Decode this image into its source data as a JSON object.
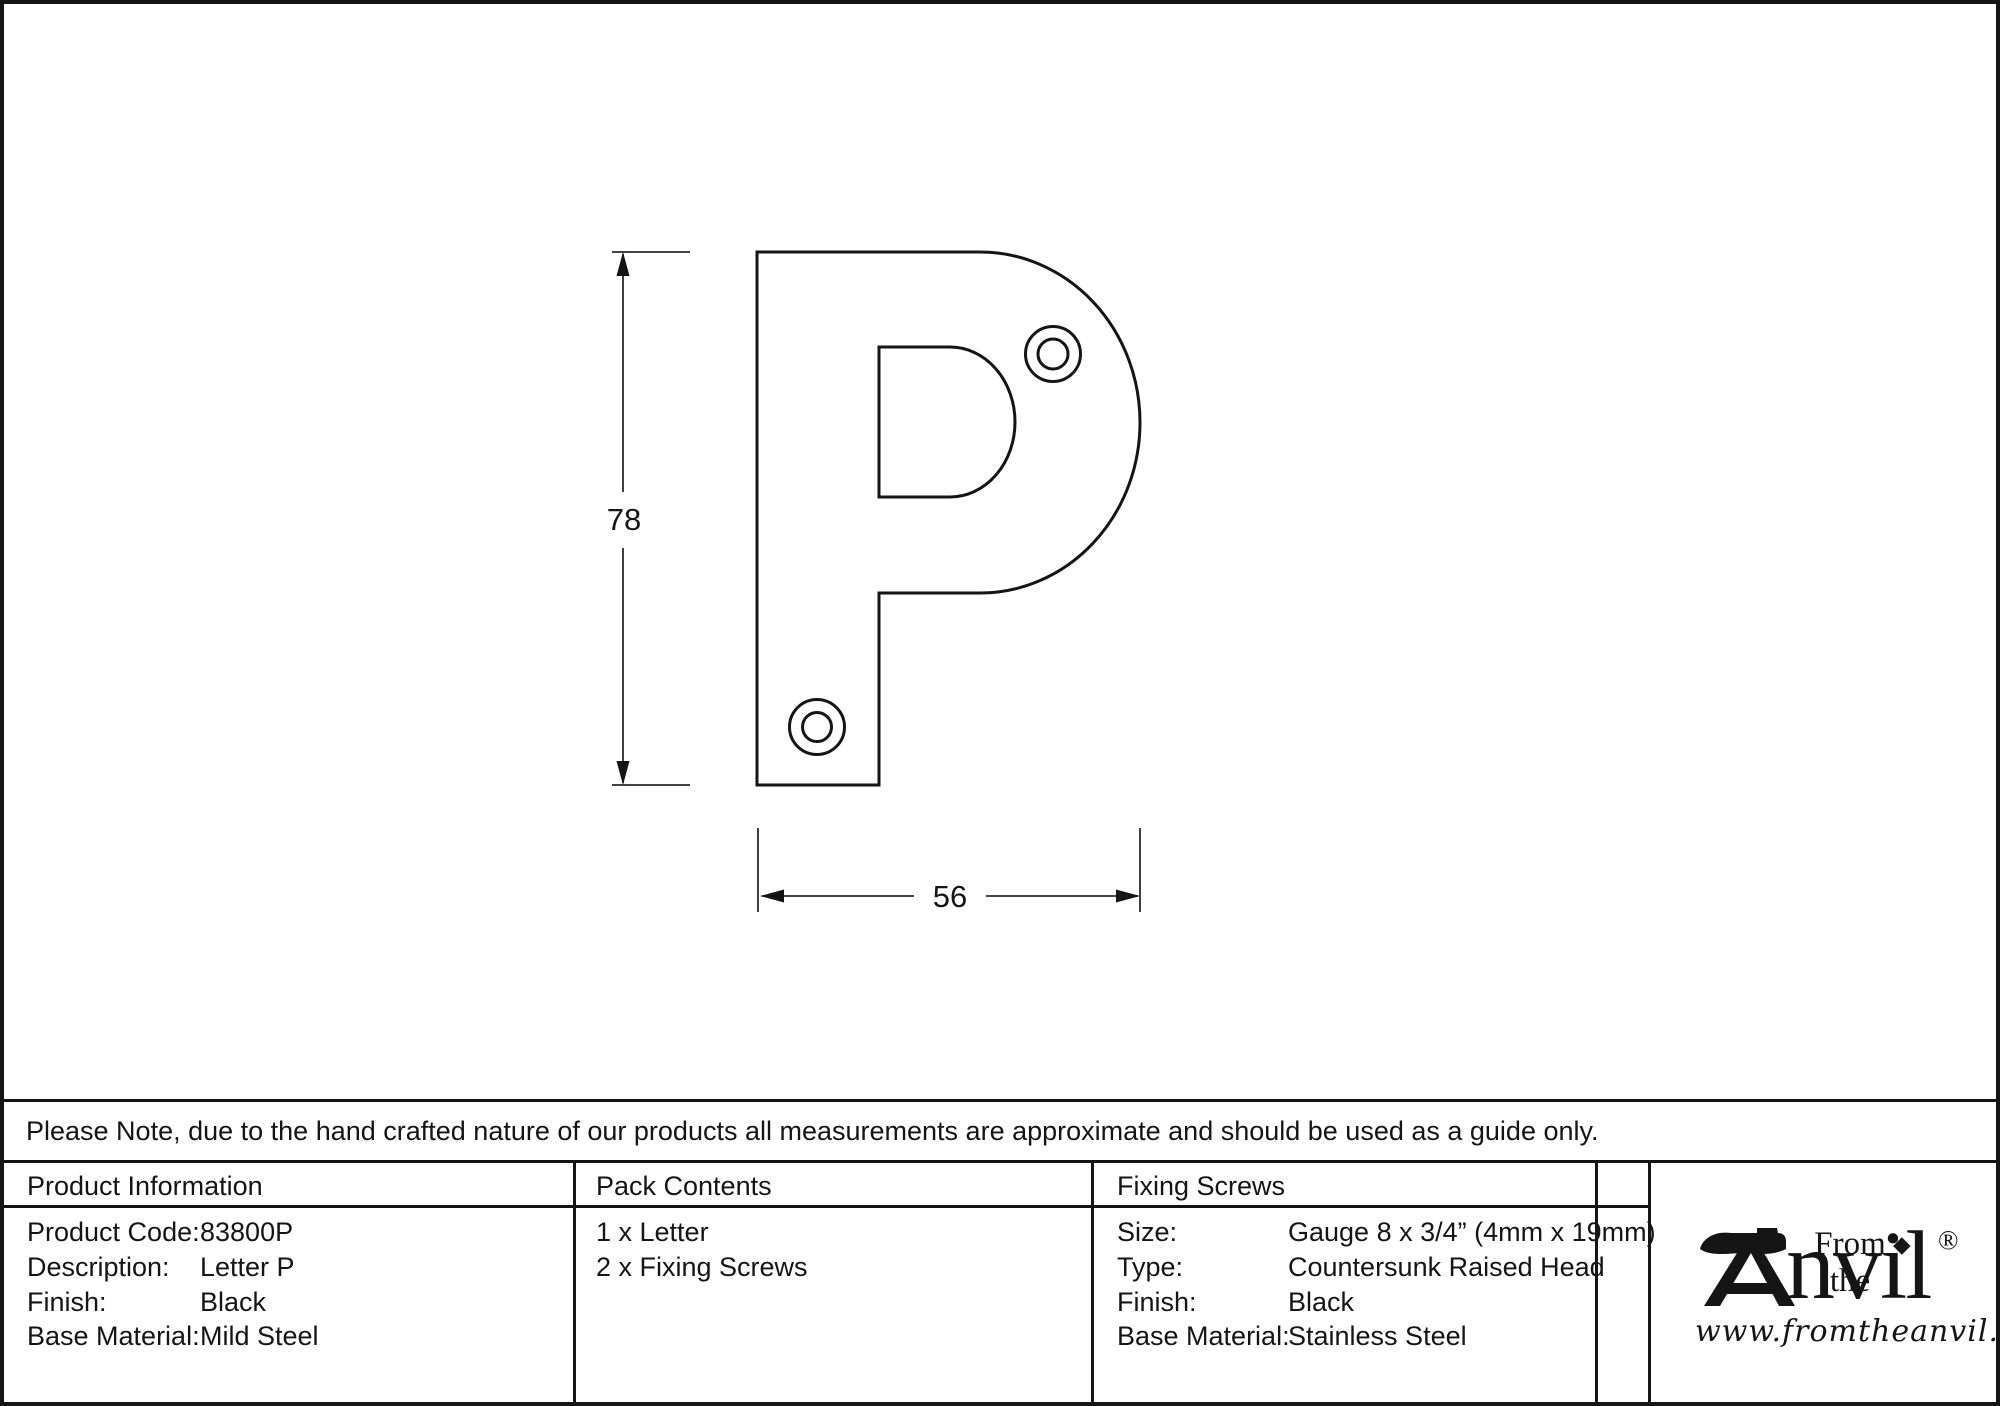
{
  "page": {
    "background": "#ffffff",
    "ink": "#151515"
  },
  "drawing": {
    "description": "Letter P outline with two screw holes",
    "height_dim": "78",
    "width_dim": "56"
  },
  "note": {
    "text": "Please Note, due to the hand crafted nature of our products all measurements are approximate and should be used as a guide only."
  },
  "table": {
    "product_information": {
      "header": "Product Information",
      "rows": [
        {
          "label": "Product Code:",
          "value": "83800P"
        },
        {
          "label": "Description:",
          "value": "Letter P"
        },
        {
          "label": "Finish:",
          "value": "Black"
        },
        {
          "label": "Base Material:",
          "value": "Mild Steel"
        }
      ]
    },
    "pack_contents": {
      "header": "Pack Contents",
      "items": [
        "1 x Letter",
        "2 x Fixing Screws"
      ]
    },
    "fixing_screws": {
      "header": "Fixing Screws",
      "rows": [
        {
          "label": "Size:",
          "value": "Gauge 8 x 3/4” (4mm x 19mm)"
        },
        {
          "label": "Type:",
          "value": "Countersunk Raised Head"
        },
        {
          "label": "Finish:",
          "value": "Black"
        },
        {
          "label": "Base Material:",
          "value": "Stainless Steel"
        }
      ]
    }
  },
  "logo": {
    "prefix": "From the",
    "brand_suffix": "nvil",
    "diamond": "◆",
    "registered_mark": "®",
    "website": "www.fromtheanvil.co.uk"
  }
}
